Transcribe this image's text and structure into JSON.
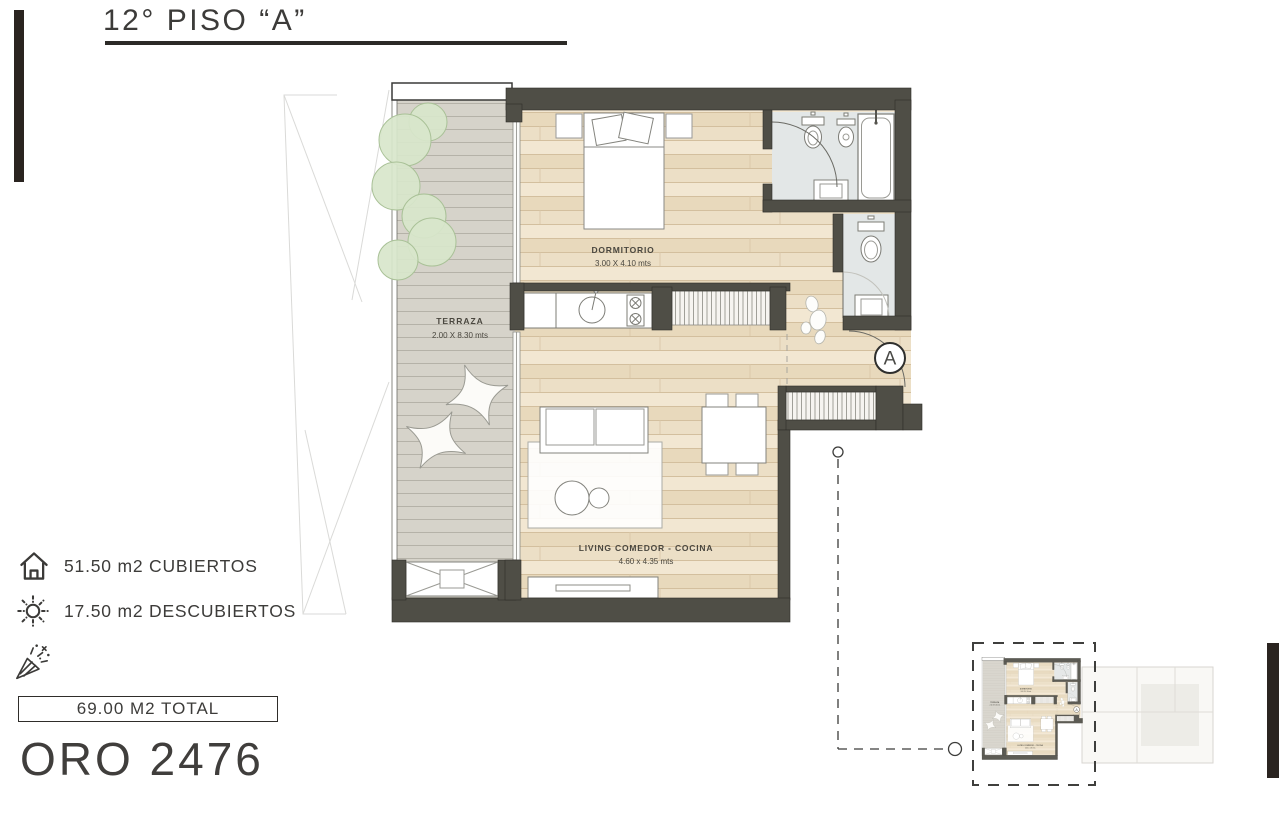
{
  "page": {
    "title": "12° PISO “A”"
  },
  "plan": {
    "unit_marker": "A",
    "rooms": [
      {
        "name": "terraza",
        "label": "TERRAZA",
        "dims": "2.00 X 8.30 mts"
      },
      {
        "name": "dormitorio",
        "label": "DORMITORIO",
        "dims": "3.00 X 4.10 mts"
      },
      {
        "name": "living",
        "label": "LIVING COMEDOR - COCINA",
        "dims": "4.60 x 4.35 mts"
      }
    ]
  },
  "legend": {
    "items": [
      {
        "icon": "house-icon",
        "text": "51.50 m2 CUBIERTOS"
      },
      {
        "icon": "sun-icon",
        "text": "17.50 m2 DESCUBIERTOS"
      },
      {
        "icon": "confetti-icon",
        "text": ""
      }
    ],
    "total": "69.00 M2 TOTAL"
  },
  "project": {
    "name": "ORO 2476"
  },
  "colors": {
    "wall": "#4f4e46",
    "wood": "#ecdfc6",
    "deck": "#d6d3ca",
    "tile": "#e3e7e7",
    "tree": "#d8e6cb",
    "accent_dark": "#2a2420"
  }
}
